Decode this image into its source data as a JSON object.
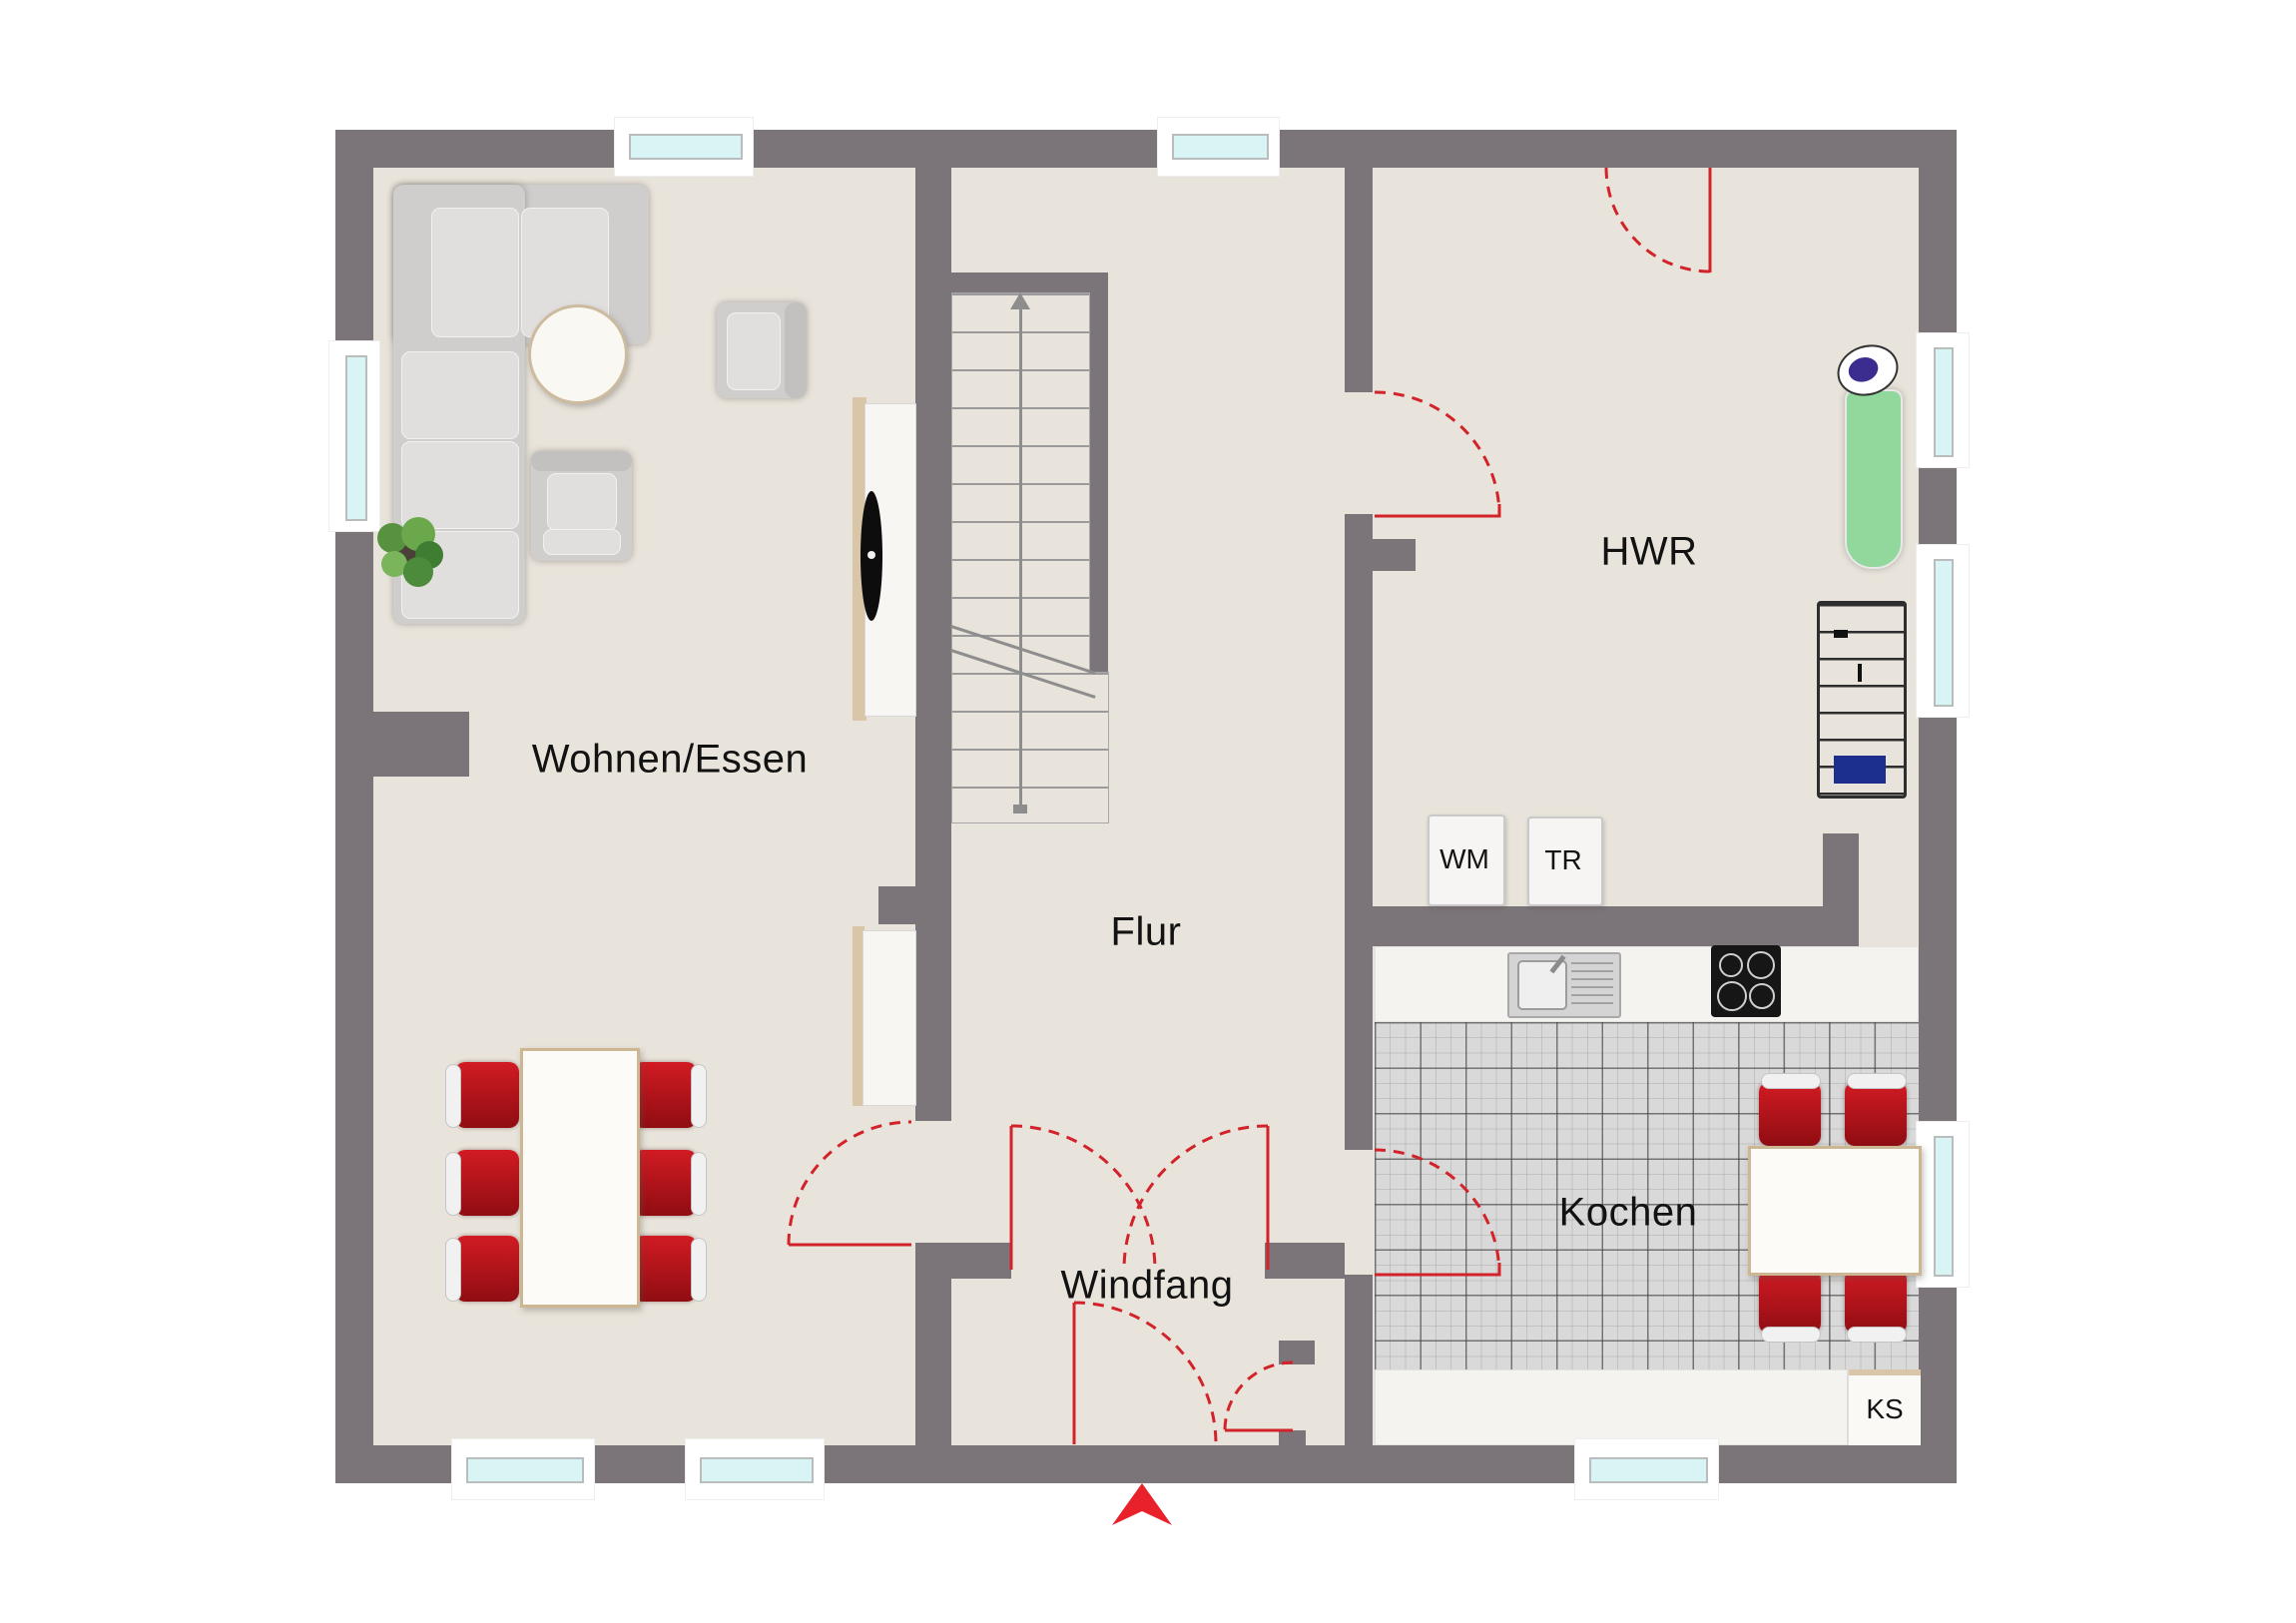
{
  "title": "Grundriss Erdgeschoss",
  "rooms": {
    "wohnen": {
      "label": "Wohnen/Essen"
    },
    "flur": {
      "label": "Flur"
    },
    "hwr": {
      "label": "HWR"
    },
    "kochen": {
      "label": "Kochen"
    },
    "windfang": {
      "label": "Windfang"
    }
  },
  "appliances": {
    "wm": {
      "label": "WM"
    },
    "tr": {
      "label": "TR"
    },
    "ks": {
      "label": "KS"
    }
  },
  "colors": {
    "wall": "#7b7478",
    "floor": "#e9e4db",
    "tile": "#d9d9d9",
    "accent_red": "#d2232a",
    "window_glass": "#d8f4f4",
    "chair_red": "#bb1118",
    "ironing_board": "#92d89d"
  },
  "icons": {
    "entrance_arrow": "red chevron marking main entrance",
    "stairs": "straight stair run with up arrow",
    "corner_sofa": "L-shaped sofa",
    "armchair": "armchair",
    "side_table": "round table",
    "plant": "potted plant",
    "tv_sideboard": "lowboard with TV",
    "dining_table": "table with 6 chairs",
    "kitchen_table": "table with 4 chairs",
    "sink": "kitchen sink",
    "hob": "cooktop with 4 rings",
    "washing_machine": "WM",
    "dryer": "TR",
    "fridge": "KS",
    "ironing_board": "ironing board with iron",
    "drying_rack": "laundry drying rack"
  }
}
